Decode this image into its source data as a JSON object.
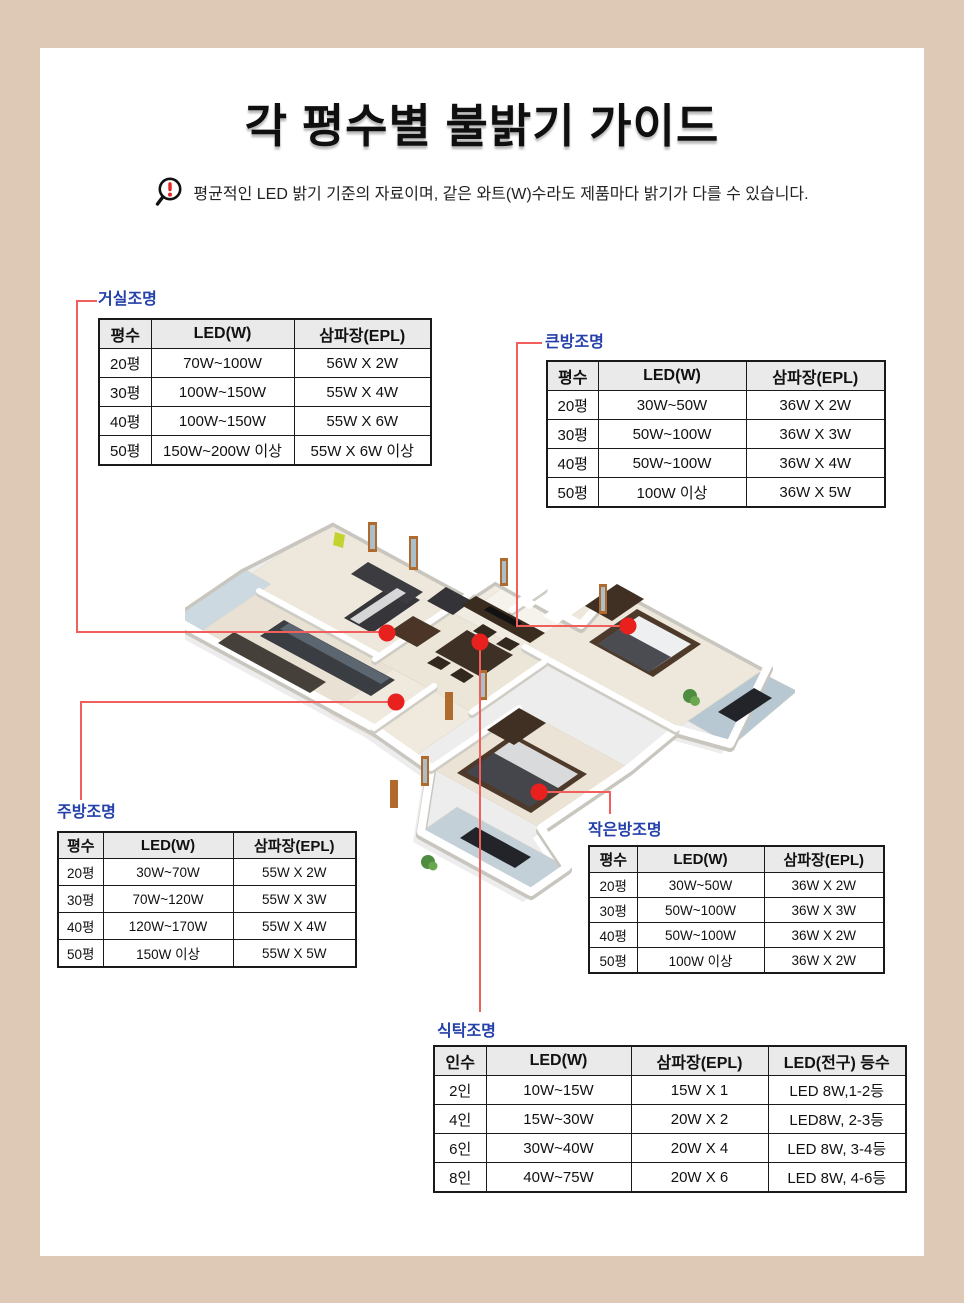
{
  "page": {
    "title": "각 평수별 불밝기 가이드",
    "notice": "평균적인 LED 밝기 기준의 자료이며, 같은 와트(W)수라도 제품마다 밝기가 다를 수 있습니다.",
    "background_color": "#ddc9b5",
    "card_color": "#ffffff",
    "label_blue": "#2440aa",
    "marker_red": "#e8211e",
    "connector_red": "#f15f5d",
    "table_header_gray": "#eaeaea"
  },
  "tables": {
    "living": {
      "label": "거실조명",
      "headers": [
        "평수",
        "LED(W)",
        "삼파장(EPL)"
      ],
      "rows": [
        [
          "20평",
          "70W~100W",
          "56W X 2W"
        ],
        [
          "30평",
          "100W~150W",
          "55W X 4W"
        ],
        [
          "40평",
          "100W~150W",
          "55W X 6W"
        ],
        [
          "50평",
          "150W~200W 이상",
          "55W X 6W 이상"
        ]
      ]
    },
    "big_room": {
      "label": "큰방조명",
      "headers": [
        "평수",
        "LED(W)",
        "삼파장(EPL)"
      ],
      "rows": [
        [
          "20평",
          "30W~50W",
          "36W X 2W"
        ],
        [
          "30평",
          "50W~100W",
          "36W X 3W"
        ],
        [
          "40평",
          "50W~100W",
          "36W X 4W"
        ],
        [
          "50평",
          "100W 이상",
          "36W X 5W"
        ]
      ]
    },
    "kitchen": {
      "label": "주방조명",
      "headers": [
        "평수",
        "LED(W)",
        "삼파장(EPL)"
      ],
      "rows": [
        [
          "20평",
          "30W~70W",
          "55W X 2W"
        ],
        [
          "30평",
          "70W~120W",
          "55W X 3W"
        ],
        [
          "40평",
          "120W~170W",
          "55W X 4W"
        ],
        [
          "50평",
          "150W 이상",
          "55W X 5W"
        ]
      ]
    },
    "small_room": {
      "label": "작은방조명",
      "headers": [
        "평수",
        "LED(W)",
        "삼파장(EPL)"
      ],
      "rows": [
        [
          "20평",
          "30W~50W",
          "36W X 2W"
        ],
        [
          "30평",
          "50W~100W",
          "36W X 3W"
        ],
        [
          "40평",
          "50W~100W",
          "36W X 2W"
        ],
        [
          "50평",
          "100W 이상",
          "36W X 2W"
        ]
      ]
    },
    "dining": {
      "label": "식탁조명",
      "headers": [
        "인수",
        "LED(W)",
        "삼파장(EPL)",
        "LED(전구) 등수"
      ],
      "rows": [
        [
          "2인",
          "10W~15W",
          "15W X 1",
          "LED 8W,1-2등"
        ],
        [
          "4인",
          "15W~30W",
          "20W X 2",
          "LED8W, 2-3등"
        ],
        [
          "6인",
          "30W~40W",
          "20W X 4",
          "LED 8W, 3-4등"
        ],
        [
          "8인",
          "40W~75W",
          "20W X 6",
          "LED 8W, 4-6등"
        ]
      ]
    }
  },
  "floor_plan": {
    "markers": [
      "거실조명",
      "식탁조명",
      "주방조명",
      "큰방조명",
      "작은방조명"
    ]
  }
}
